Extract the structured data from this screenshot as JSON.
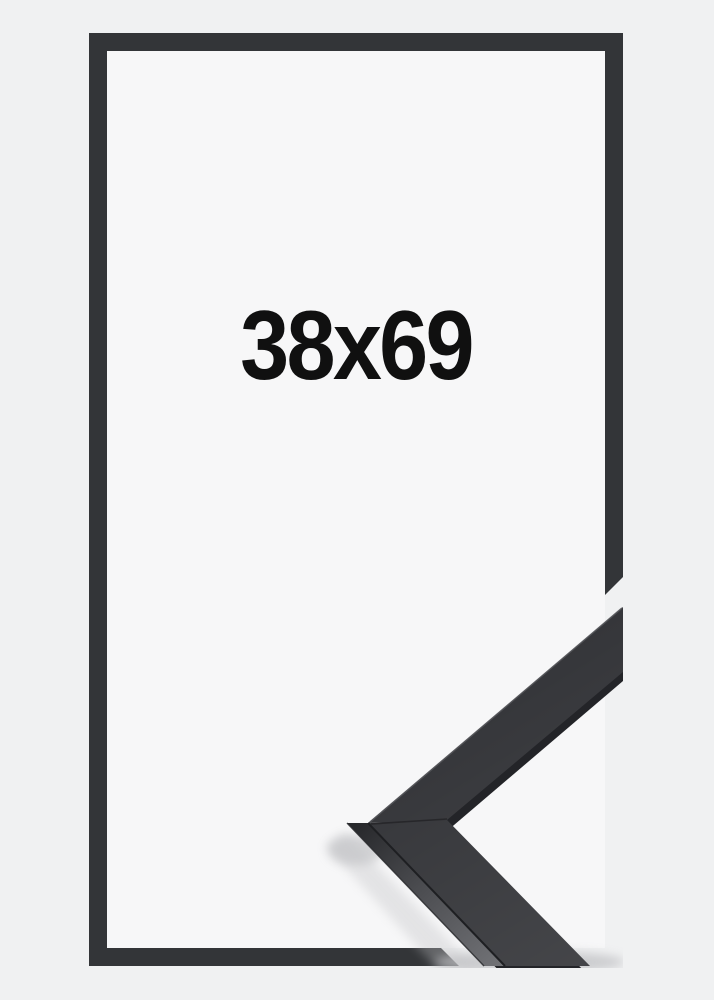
{
  "product": {
    "size_label": "38x69"
  },
  "colors": {
    "page_background": "#f0f1f2",
    "mat_background": "#f7f7f8",
    "frame_outline": "#333538",
    "molding_face": "#313236",
    "molding_underside": "#232428",
    "molding_side_light": "#6f7074",
    "shadow": "#bfc0c3",
    "label_text": "#101010"
  }
}
